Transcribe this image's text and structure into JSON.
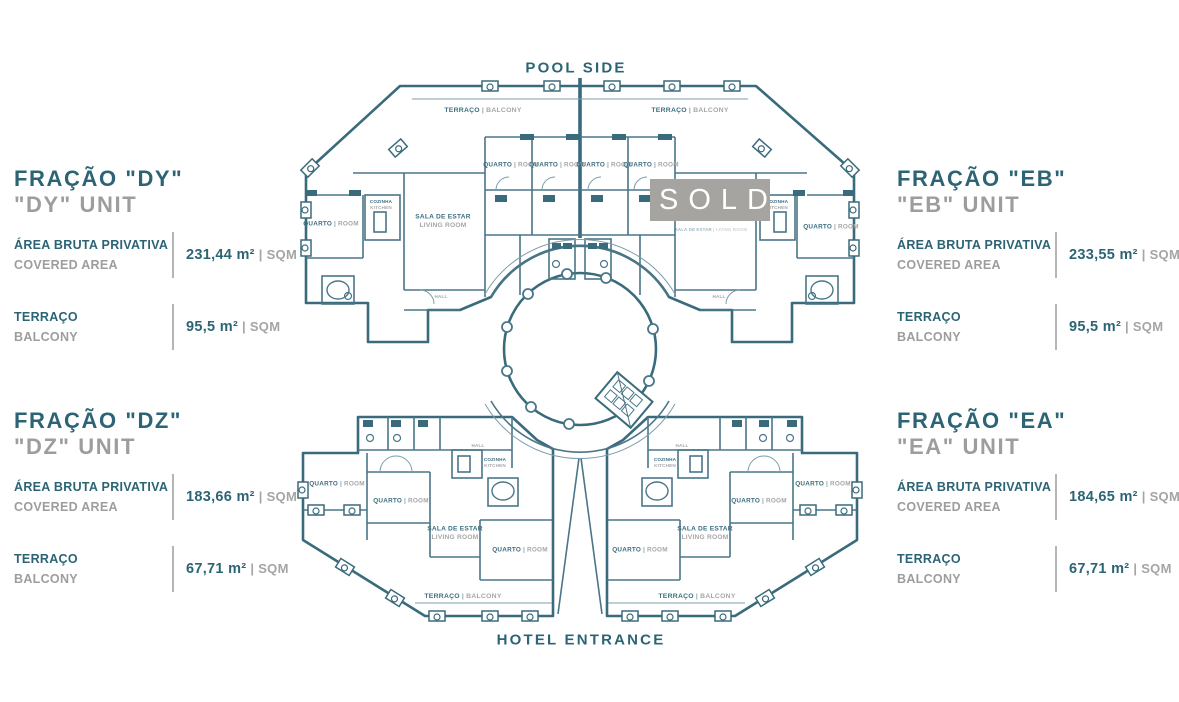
{
  "colors": {
    "accent_teal": "#2c6476",
    "text_gray": "#9d9d9d",
    "wall_teal": "#3a6b7c",
    "sold_gray": "#a5a4a0",
    "sold_text": "#ffffff"
  },
  "plan": {
    "pool_side_label": "POOL SIDE",
    "hotel_entrance_label": "HOTEL ENTRANCE",
    "sold_label": "SOLD",
    "labels": [
      {
        "type": "pair",
        "x": 483,
        "y": 110,
        "pt": "TERRAÇO",
        "en": "BALCONY",
        "s": 0.62
      },
      {
        "type": "pair",
        "x": 690,
        "y": 110,
        "pt": "TERRAÇO",
        "en": "BALCONY",
        "s": 0.62
      },
      {
        "type": "pair",
        "x": 511,
        "y": 165,
        "pt": "QUARTO",
        "en": "ROOM",
        "s": 0.58
      },
      {
        "type": "pair",
        "x": 557,
        "y": 165,
        "pt": "QUARTO",
        "en": "ROOM",
        "s": 0.58
      },
      {
        "type": "pair",
        "x": 604,
        "y": 165,
        "pt": "QUARTO",
        "en": "ROOM",
        "s": 0.58
      },
      {
        "type": "pair",
        "x": 651,
        "y": 165,
        "pt": "QUARTO",
        "en": "ROOM",
        "s": 0.58
      },
      {
        "type": "pair",
        "x": 331,
        "y": 224,
        "pt": "QUARTO",
        "en": "ROOM",
        "s": 0.58
      },
      {
        "type": "pair",
        "x": 831,
        "y": 227,
        "pt": "QUARTO",
        "en": "ROOM",
        "s": 0.58
      },
      {
        "type": "stack",
        "x": 381,
        "y": 205,
        "pt": "COZINHA",
        "en": "KITCHEN",
        "s": 0.42
      },
      {
        "type": "stack",
        "x": 777,
        "y": 205,
        "pt": "COZINHA",
        "en": "KITCHEN",
        "s": 0.42
      },
      {
        "type": "stack",
        "x": 443,
        "y": 221,
        "pt": "SALA DE ESTAR",
        "en": "LIVING ROOM",
        "s": 0.6
      },
      {
        "type": "pair",
        "x": 711,
        "y": 230,
        "pt": "SALA DE ESTAR",
        "en": "LIVING ROOM",
        "s": 0.4,
        "o": 0.5
      },
      {
        "type": "single",
        "x": 441,
        "y": 297,
        "t": "HALL",
        "s": 0.42
      },
      {
        "type": "single",
        "x": 719,
        "y": 297,
        "t": "HALL",
        "s": 0.42
      },
      {
        "type": "single",
        "x": 478,
        "y": 446,
        "t": "HALL",
        "s": 0.42
      },
      {
        "type": "single",
        "x": 682,
        "y": 446,
        "t": "HALL",
        "s": 0.42
      },
      {
        "type": "stack",
        "x": 495,
        "y": 463,
        "pt": "COZINHA",
        "en": "KITCHEN",
        "s": 0.42
      },
      {
        "type": "stack",
        "x": 665,
        "y": 463,
        "pt": "COZINHA",
        "en": "KITCHEN",
        "s": 0.42
      },
      {
        "type": "pair",
        "x": 337,
        "y": 484,
        "pt": "QUARTO",
        "en": "ROOM",
        "s": 0.58
      },
      {
        "type": "pair",
        "x": 823,
        "y": 484,
        "pt": "QUARTO",
        "en": "ROOM",
        "s": 0.58
      },
      {
        "type": "pair",
        "x": 401,
        "y": 501,
        "pt": "QUARTO",
        "en": "ROOM",
        "s": 0.58
      },
      {
        "type": "pair",
        "x": 759,
        "y": 501,
        "pt": "QUARTO",
        "en": "ROOM",
        "s": 0.58
      },
      {
        "type": "stack",
        "x": 455,
        "y": 533,
        "pt": "SALA DE ESTAR",
        "en": "LIVING ROOM",
        "s": 0.6
      },
      {
        "type": "stack",
        "x": 705,
        "y": 533,
        "pt": "SALA DE ESTAR",
        "en": "LIVING ROOM",
        "s": 0.6
      },
      {
        "type": "pair",
        "x": 520,
        "y": 550,
        "pt": "QUARTO",
        "en": "ROOM",
        "s": 0.58
      },
      {
        "type": "pair",
        "x": 640,
        "y": 550,
        "pt": "QUARTO",
        "en": "ROOM",
        "s": 0.58
      },
      {
        "type": "pair",
        "x": 463,
        "y": 596,
        "pt": "TERRAÇO",
        "en": "BALCONY",
        "s": 0.62
      },
      {
        "type": "pair",
        "x": 697,
        "y": 596,
        "pt": "TERRAÇO",
        "en": "BALCONY",
        "s": 0.62
      }
    ]
  },
  "panels": [
    {
      "id": "DY",
      "title": "FRAÇÃO \"DY\"",
      "subtitle": "\"DY\" UNIT",
      "rows": [
        {
          "label_pt": "ÁREA BRUTA PRIVATIVA",
          "label_en": "COVERED AREA",
          "value": "231,44 m²",
          "suffix": " | SQM"
        },
        {
          "label_pt": "TERRAÇO",
          "label_en": "BALCONY",
          "value": "95,5 m²",
          "suffix": " | SQM"
        }
      ]
    },
    {
      "id": "EB",
      "title": "FRAÇÃO \"EB\"",
      "subtitle": "\"EB\" UNIT",
      "rows": [
        {
          "label_pt": "ÁREA BRUTA PRIVATIVA",
          "label_en": "COVERED AREA",
          "value": "233,55 m²",
          "suffix": " | SQM"
        },
        {
          "label_pt": "TERRAÇO",
          "label_en": "BALCONY",
          "value": "95,5 m²",
          "suffix": " | SQM"
        }
      ]
    },
    {
      "id": "DZ",
      "title": "FRAÇÃO \"DZ\"",
      "subtitle": "\"DZ\" UNIT",
      "rows": [
        {
          "label_pt": "ÁREA BRUTA PRIVATIVA",
          "label_en": "COVERED AREA",
          "value": "183,66 m²",
          "suffix": " | SQM"
        },
        {
          "label_pt": "TERRAÇO",
          "label_en": "BALCONY",
          "value": "67,71 m²",
          "suffix": " | SQM"
        }
      ]
    },
    {
      "id": "EA",
      "title": "FRAÇÃO \"EA\"",
      "subtitle": "\"EA\" UNIT",
      "rows": [
        {
          "label_pt": "ÁREA BRUTA PRIVATIVA",
          "label_en": "COVERED AREA",
          "value": "184,65 m²",
          "suffix": " | SQM"
        },
        {
          "label_pt": "TERRAÇO",
          "label_en": "BALCONY",
          "value": "67,71 m²",
          "suffix": " | SQM"
        }
      ]
    }
  ]
}
